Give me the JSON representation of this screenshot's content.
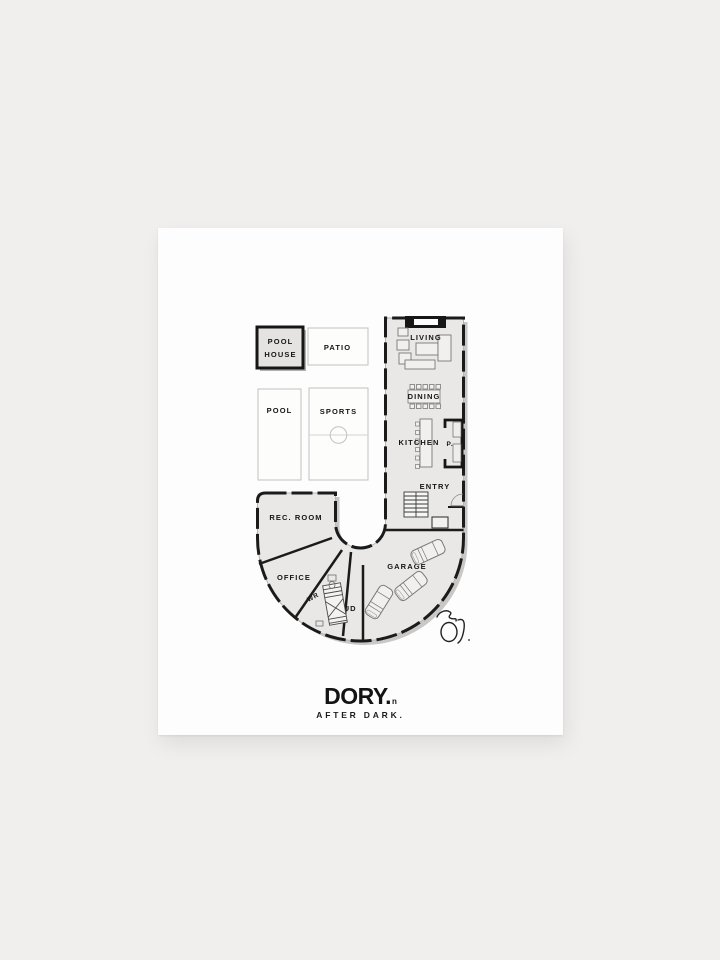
{
  "poster": {
    "plan": {
      "outdoor": {
        "pool_house_line1": "POOL",
        "pool_house_line2": "HOUSE",
        "patio": "PATIO",
        "pool": "POOL",
        "sports": "SPORTS"
      },
      "rooms": {
        "living": "LIVING",
        "dining": "DINING",
        "kitchen": "KITCHEN",
        "pantry": "P.",
        "entry": "ENTRY",
        "rec_room": "REC. ROOM",
        "office": "OFFICE",
        "wr": "WR",
        "mud": "MUD",
        "garage": "GARAGE"
      }
    },
    "brand": {
      "name": "DORY.",
      "mark": "n",
      "tagline": "AFTER DARK."
    },
    "colors": {
      "background": "#f0efee",
      "poster": "#fdfdfd",
      "floor": "#e9e8e6",
      "wall": "#1b1b1b",
      "plan_shadow": "#c9c8c6",
      "label": "#161616"
    }
  }
}
